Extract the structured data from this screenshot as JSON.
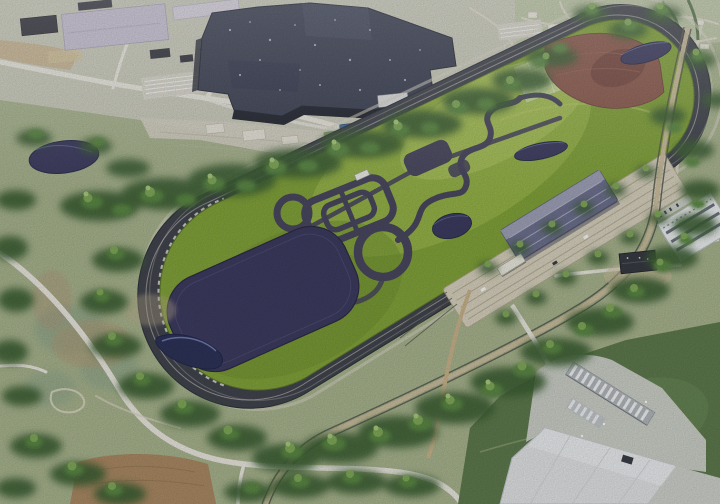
{
  "meta": {
    "width": 720,
    "height": 504,
    "kind": "3d-aerial-rendering"
  },
  "landmarks": [
    "factory-building",
    "office-buildings",
    "parking-lots",
    "retention-pond",
    "proving-ground-oval",
    "high-speed-track",
    "infield-handling-course",
    "skid-circle",
    "vehicle-dynamics-pad",
    "infield-ponds",
    "off-road-dirt-area",
    "test-plot-field",
    "multi-lane-straight",
    "track-garage",
    "rail-corridor",
    "perimeter-road",
    "tree-belt",
    "warehouse",
    "loading-docks",
    "industrial-buildings",
    "dirt-clearing",
    "suburban-streets"
  ],
  "colors": {
    "land": "#a9b58f",
    "landPale": "#cbccbc",
    "suburb": "#bdc7a6",
    "dryField": "#c9b28b",
    "road": "#ebe9e0",
    "roadMinor": "#ddd9ca",
    "concrete": "#d6d2c4",
    "factoryRoof": "#3b4053",
    "factoryFace": "#20242f",
    "roofPanelLight": "#464c62",
    "roofPanelDark": "#333850",
    "lavender": "#c8c1d4",
    "lavenderLight": "#d8d2df",
    "darkShed": "#32333d",
    "parking": "#c6cad0",
    "parkingLight": "#d8d6cb",
    "blueRoof": "#4a6fa5",
    "water": "#3d3c61",
    "waterDeep": "#2e3359",
    "waterRim": "#7f8fc7",
    "trackAsphalt": "#42454e",
    "trackLine": "#eceae0",
    "serviceRing": "#d8d6c7",
    "infield": "#83a43b",
    "infieldLight": "#9cba4e",
    "infieldLighter": "#b2ca62",
    "infieldShade": "#6e9130",
    "mowLine": "#b9d06e",
    "handling": "#4a4860",
    "checker": "#c6da96",
    "dirt": "#8c5b4e",
    "dirtDark": "#744640",
    "highway": "#d8d2bf",
    "highwayLine": "#b4ab92",
    "garageRoof": "#6f7291",
    "garageRidge": "#c8cada",
    "rail": "#5a5d52",
    "serviceRoad": "#cdc0a0",
    "gravelRoad": "#c9b48c",
    "lawn": "#5f7b4e",
    "yard": "#d2d5cf",
    "warehouse": "#e2e4e6",
    "warehouseLight": "#f0f2f3",
    "dockStrip": "#b3b8bd",
    "trailer": "#f2f3f4",
    "stripedRoof": "#eef0f2",
    "stripe": "#596070",
    "treeDark": "#3d6136",
    "tree": "#5c8945",
    "treeLight": "#84ac5c",
    "treeBright": "#a9cb7f",
    "scrub": "#8da58b",
    "soil": "#b39b79",
    "dirtGround": "#ab8a64",
    "house": "#eceade"
  }
}
